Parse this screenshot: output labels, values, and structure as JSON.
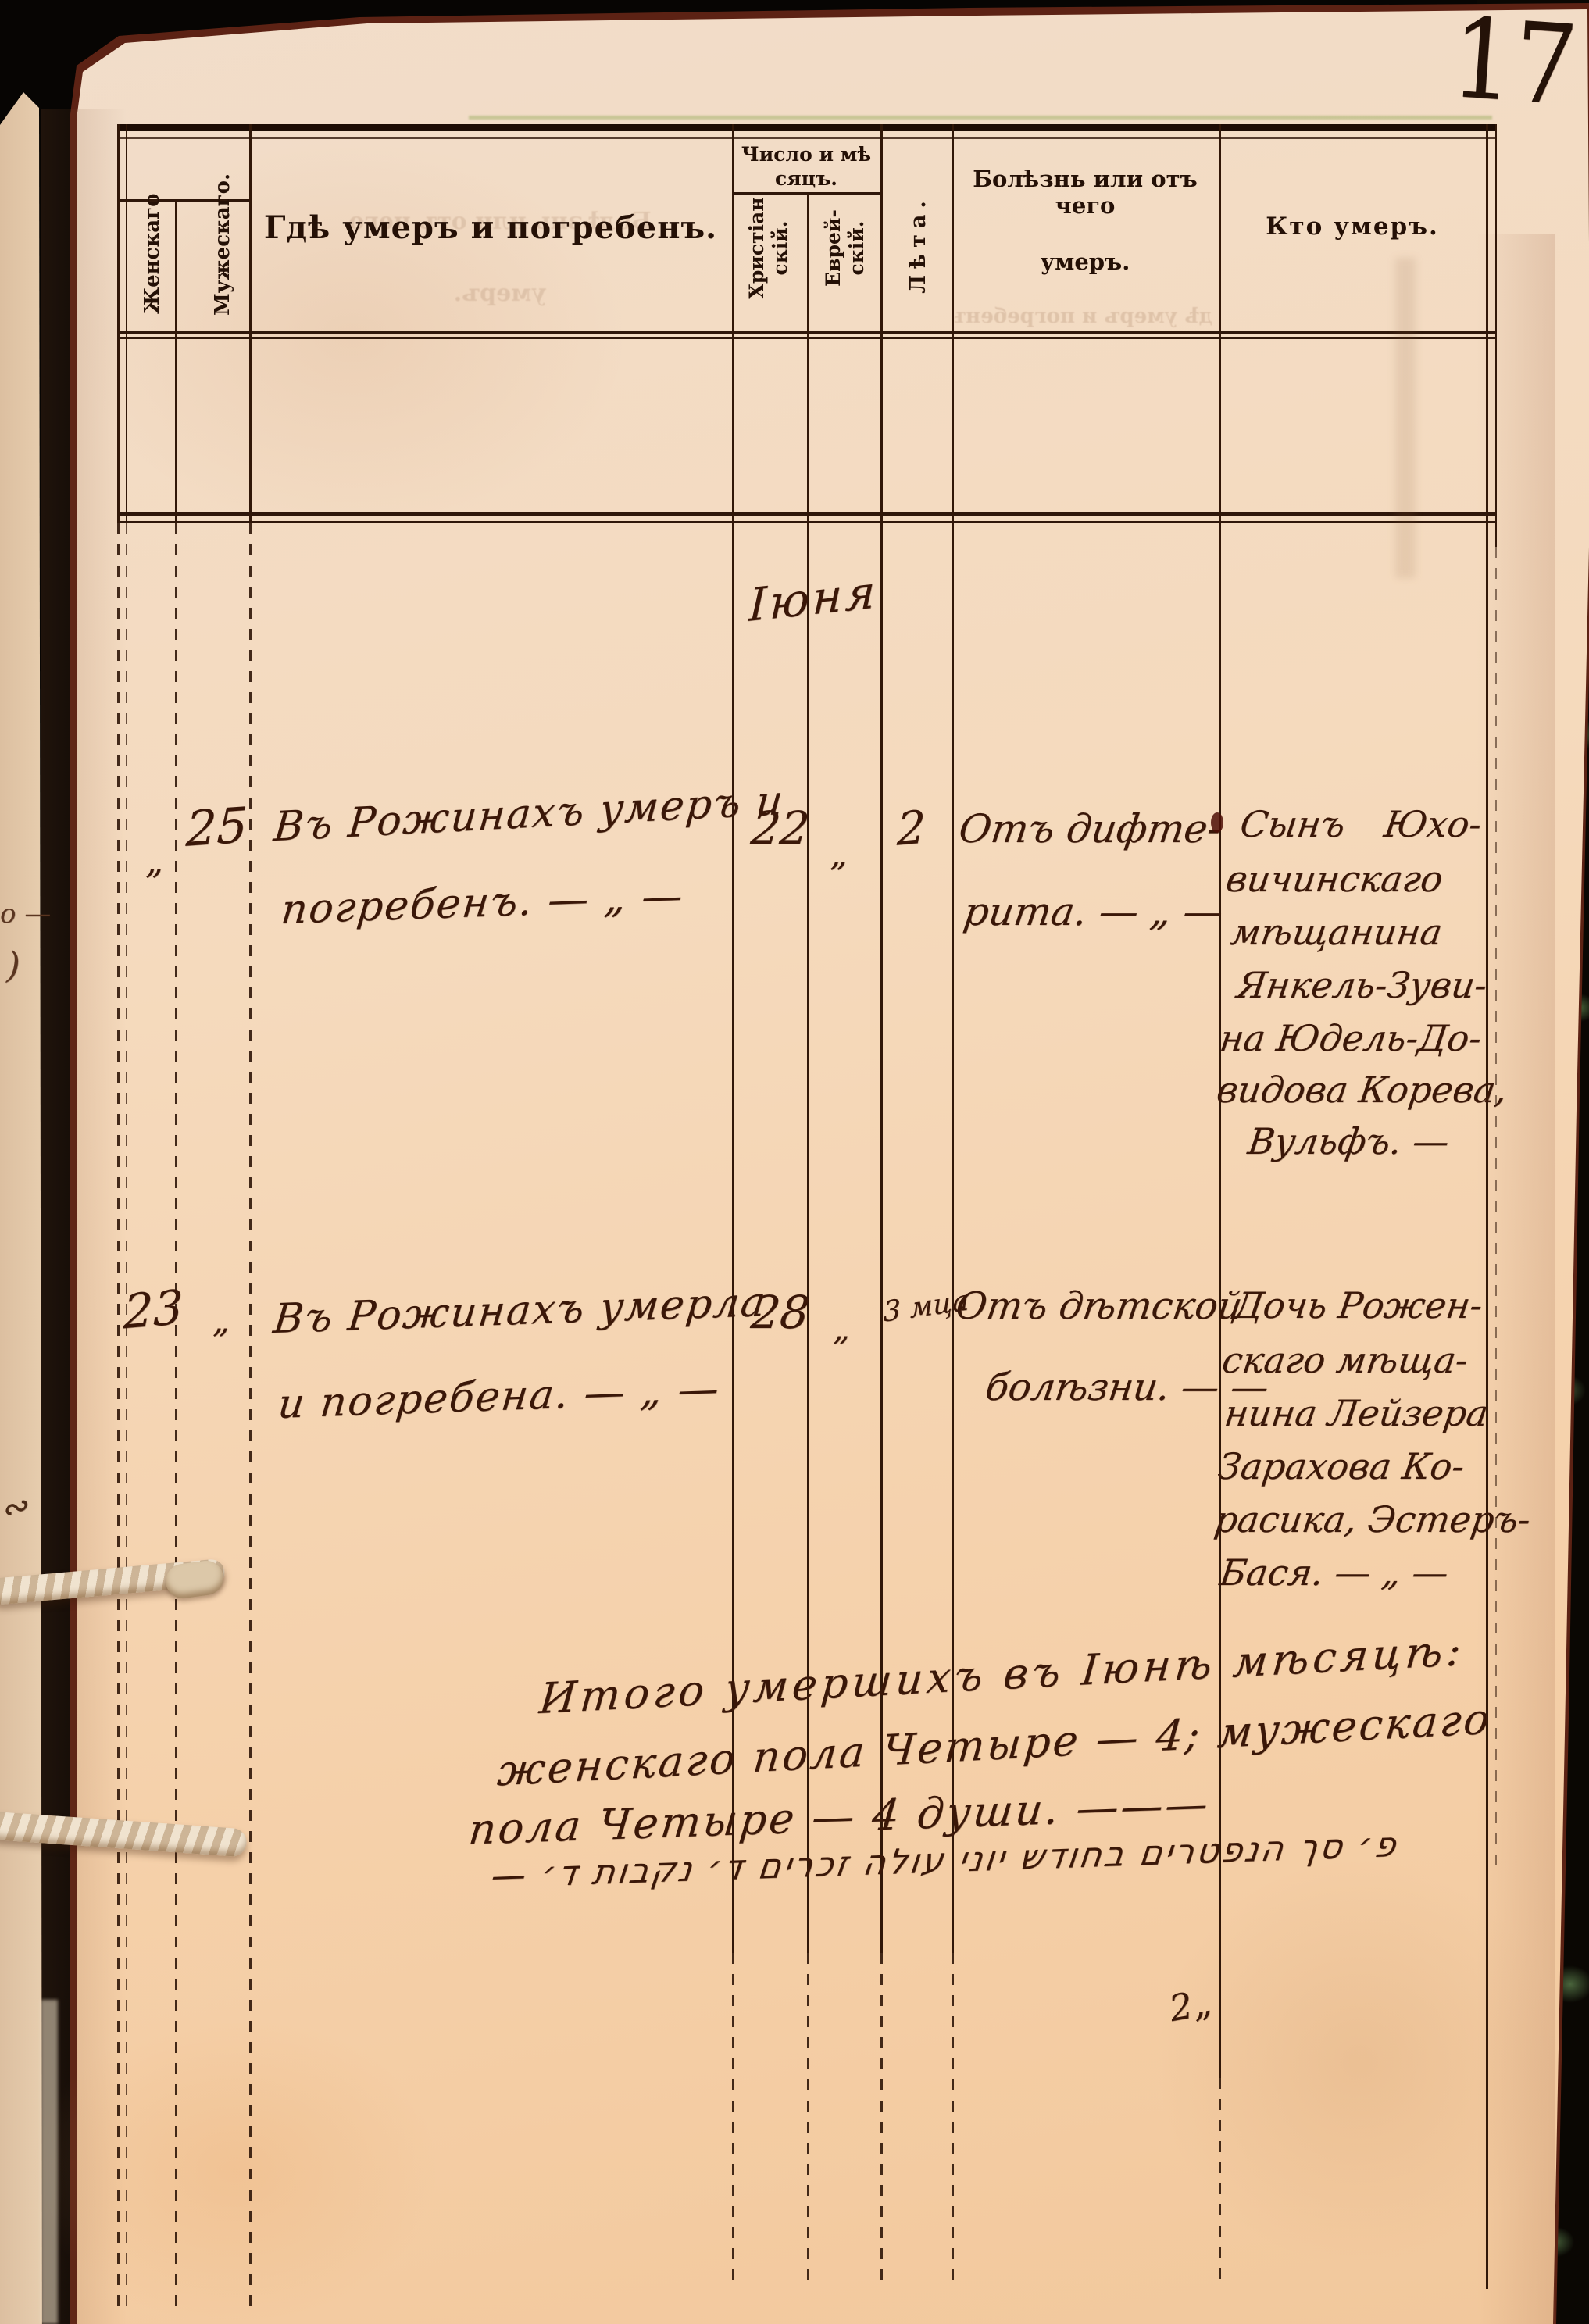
{
  "page_number": "17",
  "table": {
    "headers": {
      "female": "Женскаго",
      "male": "Мужескаго.",
      "place": "Гдѣ умеръ и погребенъ.",
      "date_group": {
        "line1": "Число и мѣ",
        "line2": "сяцъ."
      },
      "christian": {
        "line1": "Христіан",
        "line2": "скій."
      },
      "jewish": {
        "line1": "Еврей-",
        "line2": "скій."
      },
      "age": "Лѣта.",
      "cause": {
        "line1": "Болѣзнь или отъ чего",
        "line2": "умеръ."
      },
      "who": "Кто умеръ."
    },
    "month_header": "Іюня",
    "entries": [
      {
        "female_no": "„",
        "male_no": "25",
        "place": {
          "line1": "Въ Рожинахъ умеръ и",
          "line2": "погребенъ. — „ —"
        },
        "date_christian": "22",
        "date_jewish": "„",
        "age": "2",
        "cause": {
          "line1": "Отъ дифте-",
          "line2": "рита. — „ —"
        },
        "who_lines": [
          "Сынъ Юхо-",
          "вичинскаго",
          "мѣщанина",
          "Янкель-Зуви-",
          "на Юдель-До-",
          "видова Корева,",
          "Вульфъ. —"
        ]
      },
      {
        "female_no": "23",
        "male_no": "„",
        "place": {
          "line1": "Въ Рожинахъ умерла",
          "line2": "и погребена. — „ —"
        },
        "date_christian": "28",
        "date_jewish": "„",
        "age": "3 мца",
        "cause": {
          "line1": "Отъ дѣтской",
          "line2": "болѣзни. — —"
        },
        "who_lines": [
          "Дочь Рожен-",
          "скаго мѣща-",
          "нина Лейзера",
          "Зарахова Ко-",
          "расика, Эстеръ-",
          "Бася. — „ —"
        ]
      }
    ],
    "summary": {
      "line1": "Итого умершихъ въ Іюнѣ мѣсяцѣ:",
      "line2": "женскаго пола Четыре — 4; мужескаго",
      "line3": "пола Четыре — 4 души. ———"
    },
    "yiddish_line": "פ׳ סך הנפטרים בחודש יוני עולה זכרים ד׳ נקבות ד׳ —",
    "stray_mark": "2„"
  },
  "ghosts": {
    "place_line1": "Болѣзнь или отъ чего",
    "place_line2": "умеръ.",
    "cause_line": "дѣ умеръ и погребенъ."
  },
  "margin": {
    "mark1": "о —",
    "mark2": ")",
    "mark3": "∾"
  },
  "colors": {
    "paper": "#f3d7b8",
    "ink": "#3a1708",
    "rule": "#2f170a",
    "cover_black": "#0a0703",
    "marble_green": "#4e6b47"
  }
}
